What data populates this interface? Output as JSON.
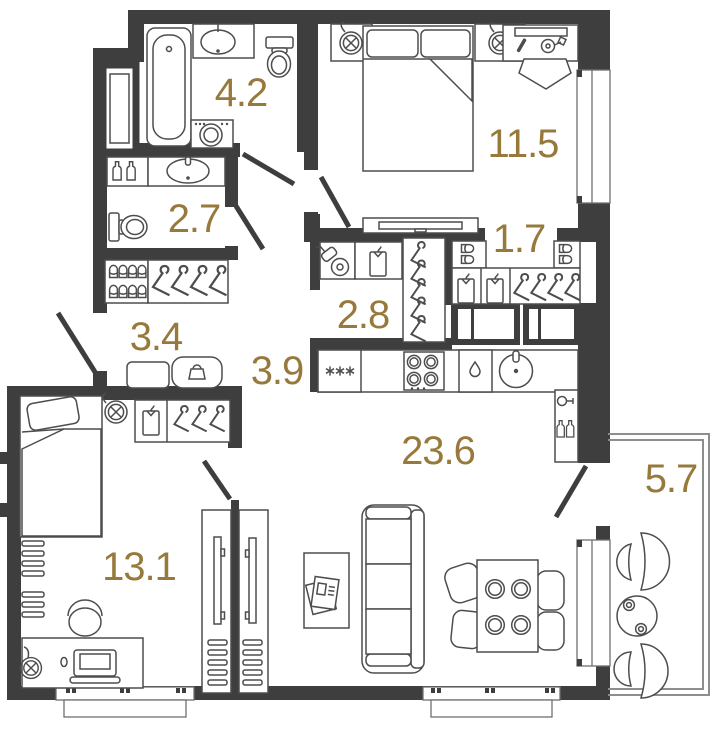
{
  "plan": {
    "type": "apartment-floor-plan",
    "colors": {
      "wall": "#3E3E3E",
      "furniture_line": "#4D4D4D",
      "room_label": "#97793C",
      "background": "#FFFFFF",
      "glazing": "#8E8E8E"
    },
    "rooms": [
      {
        "id": "bathroom",
        "area_label": "4.2",
        "furniture_icons": [
          "bathtub-icon",
          "vanity-sink-icon",
          "toilet-icon",
          "washing-machine-icon"
        ]
      },
      {
        "id": "wc",
        "area_label": "2.7",
        "furniture_icons": [
          "detergent-bottles-icon",
          "vanity-sink-icon",
          "toilet-icon"
        ]
      },
      {
        "id": "bedroom",
        "area_label": "11.5",
        "furniture_icons": [
          "wall-lamp-icon",
          "nightstand-icon",
          "double-bed-icon",
          "desk-icon",
          "desk-chair-icon",
          "tv-console-icon",
          "window"
        ]
      },
      {
        "id": "wardrobe-hall",
        "area_label": "1.7",
        "furniture_icons": [
          "shoe-box-icon",
          "wardrobe-shirts-icon",
          "wardrobe-hangers-icon"
        ]
      },
      {
        "id": "storage",
        "area_label": "2.8",
        "furniture_icons": [
          "vacuum-cleaner-icon",
          "folded-shirt-icon",
          "hanger-rack-icon"
        ]
      },
      {
        "id": "entry-hall",
        "area_label": "3.4",
        "furniture_icons": [
          "shoe-cabinet-icon",
          "coat-hangers-icon",
          "bench-icon",
          "handbag-icon"
        ]
      },
      {
        "id": "corridor",
        "area_label": "3.9",
        "furniture_icons": []
      },
      {
        "id": "kitchen-living-room",
        "area_label": "23.6",
        "furniture_icons": [
          "fridge-icon",
          "hob-icon",
          "dishwasher-icon",
          "kitchen-sink-icon",
          "bar-shelf-icon",
          "sofa-icon",
          "coffee-table-icon",
          "magazine-icon",
          "dining-table-icon",
          "dining-chair-icon",
          "tv-panel-icon"
        ]
      },
      {
        "id": "bedroom-2",
        "area_label": "13.1",
        "furniture_icons": [
          "single-bed-icon",
          "wall-lamp-icon",
          "wardrobe-icon",
          "wall-shelves-icon",
          "desk-icon",
          "laptop-icon",
          "chair-icon",
          "tv-panel-icon"
        ]
      },
      {
        "id": "balcony",
        "area_label": "5.7",
        "furniture_icons": [
          "armchair-icon",
          "round-table-icon",
          "cups-icon",
          "armchair-icon"
        ]
      }
    ]
  }
}
